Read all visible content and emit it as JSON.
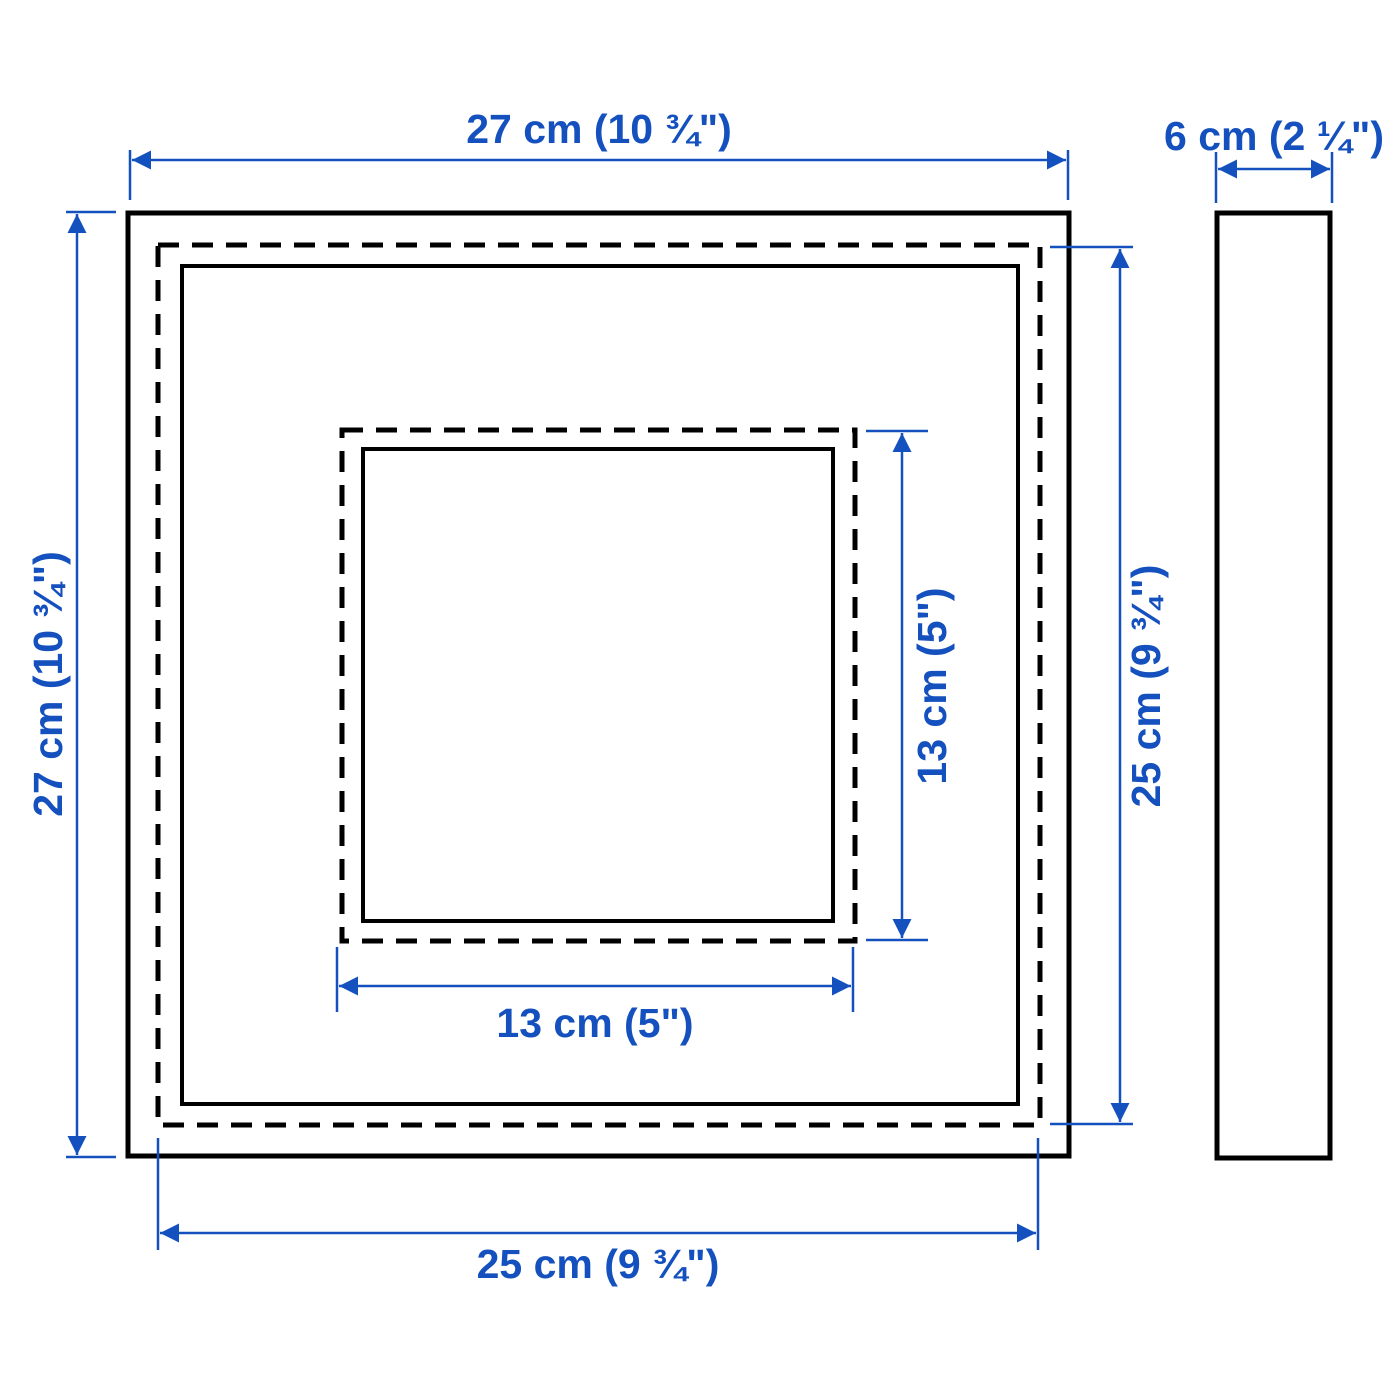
{
  "colors": {
    "accent": "#1450be",
    "outline": "#000000",
    "background": "#ffffff"
  },
  "diagram": {
    "views": {
      "front": "front-view",
      "side": "side-view"
    }
  },
  "dimensions": {
    "outer_width": "27 cm (10 ¾\")",
    "outer_height": "27 cm (10 ¾\")",
    "depth": "6 cm (2 ¼\")",
    "visible_front_width": "25 cm (9 ¾\")",
    "visible_front_height": "25 cm (9 ¾\")",
    "opening_width": "13 cm (5\")",
    "opening_height": "13 cm (5\")"
  }
}
